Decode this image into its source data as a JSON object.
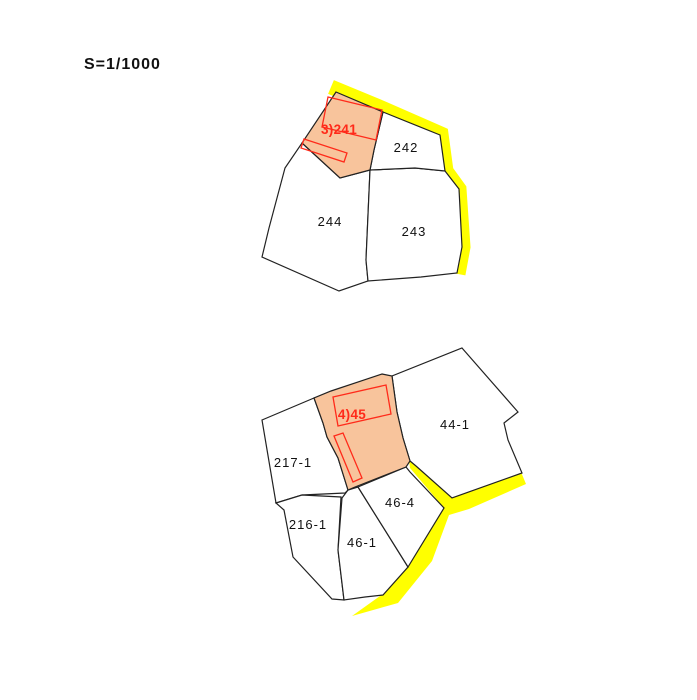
{
  "scale_label": "S=1/1000",
  "colors": {
    "background": "#FFFFFF",
    "parcel_fill": "#FFFFFF",
    "parcel_outline": "#222222",
    "highlight_fill": "#F8C49C",
    "road_highlight": "#FFFF00",
    "building_outline": "#FF2A1A",
    "label": "#111111",
    "highlight_label": "#FF2A1A"
  },
  "upper_map": {
    "name": "upper parcel group",
    "highlighted_parcel": "3)241",
    "parcels": [
      {
        "id": "241",
        "label": "3)241",
        "highlighted": true
      },
      {
        "id": "242",
        "label": "242",
        "highlighted": false
      },
      {
        "id": "243",
        "label": "243",
        "highlighted": false
      },
      {
        "id": "244",
        "label": "244",
        "highlighted": false
      }
    ]
  },
  "lower_map": {
    "name": "lower parcel group",
    "highlighted_parcel": "4)45",
    "parcels": [
      {
        "id": "45",
        "label": "4)45",
        "highlighted": true
      },
      {
        "id": "44-1",
        "label": "44-1",
        "highlighted": false
      },
      {
        "id": "217-1",
        "label": "217-1",
        "highlighted": false
      },
      {
        "id": "216-1",
        "label": "216-1",
        "highlighted": false
      },
      {
        "id": "46-1",
        "label": "46-1",
        "highlighted": false
      },
      {
        "id": "46-4",
        "label": "46-4",
        "highlighted": false
      }
    ]
  }
}
